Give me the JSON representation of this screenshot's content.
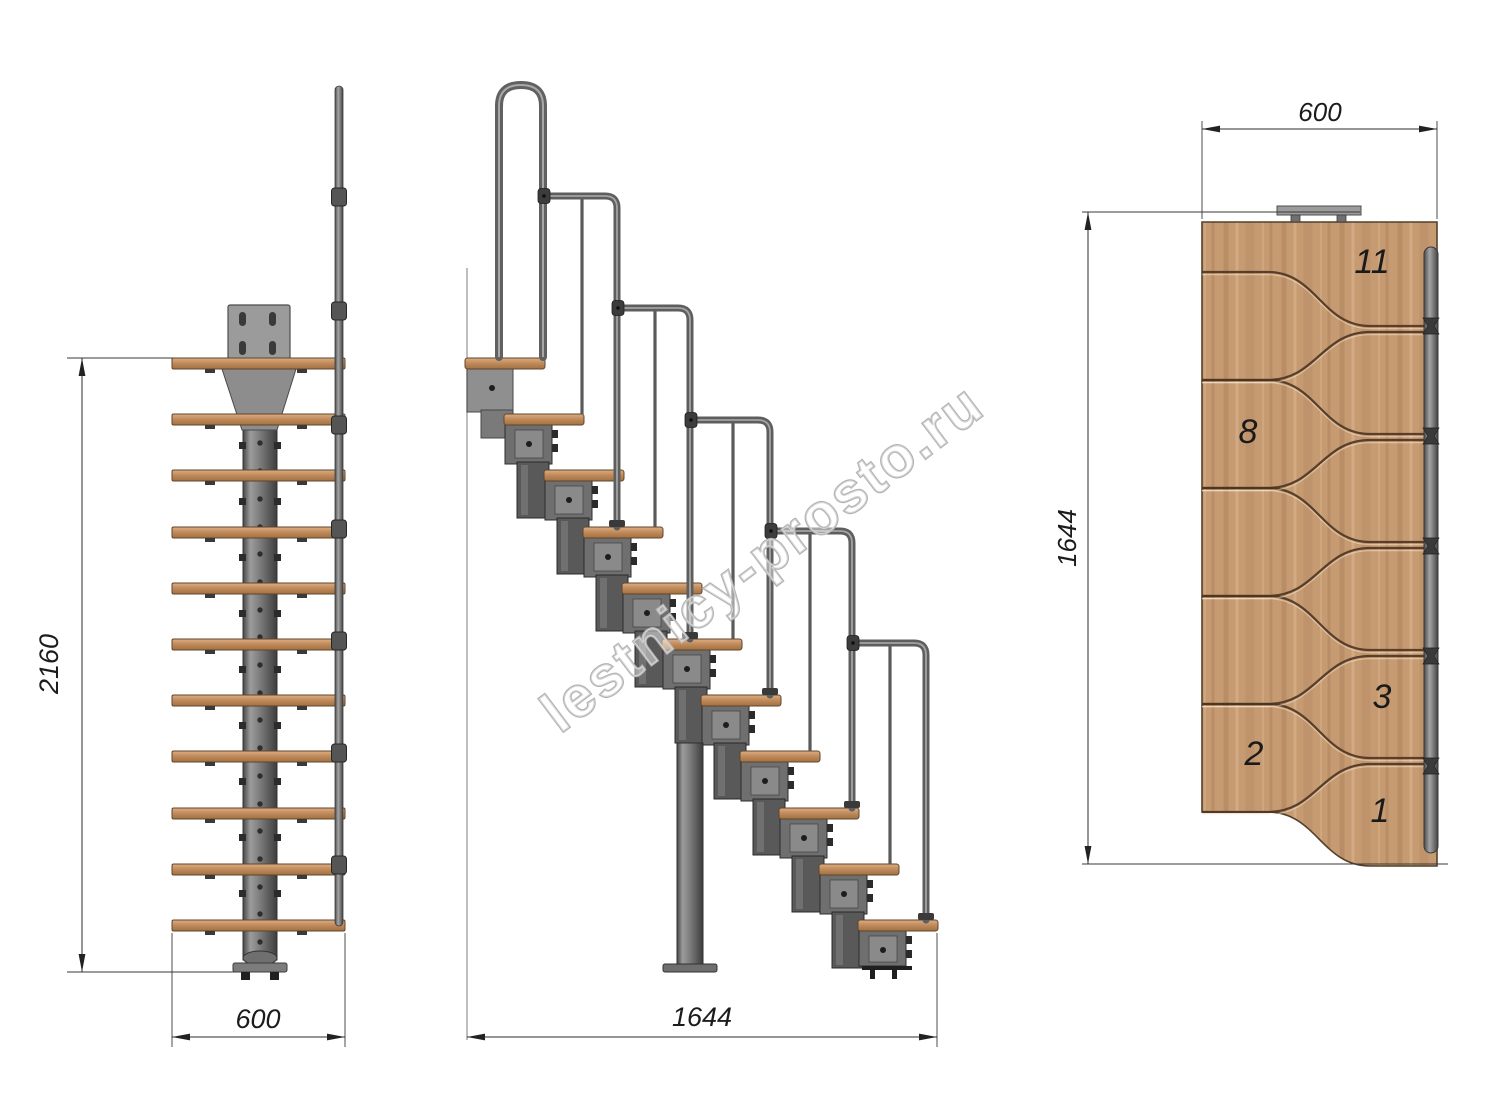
{
  "drawing": {
    "watermark": "lestnicy-prosto.ru",
    "views": {
      "front": {
        "name": "front-elevation",
        "dim_height": "2160",
        "dim_width": "600",
        "tread_count": 11
      },
      "side": {
        "name": "side-elevation",
        "dim_length": "1644",
        "tread_count": 11,
        "rail_count": 5
      },
      "top": {
        "name": "plan-view",
        "dim_width": "600",
        "dim_length": "1644",
        "tread_numbers": [
          "11",
          "8",
          "3",
          "2",
          "1"
        ]
      }
    },
    "colors": {
      "wood": "#c79b72",
      "wood_edge": "#5f452c",
      "steel": "#7d7d7d",
      "steel_dark": "#3f3f3f",
      "dimension": "#2c2c2c",
      "watermark_gray": "#b2b2b2"
    }
  }
}
